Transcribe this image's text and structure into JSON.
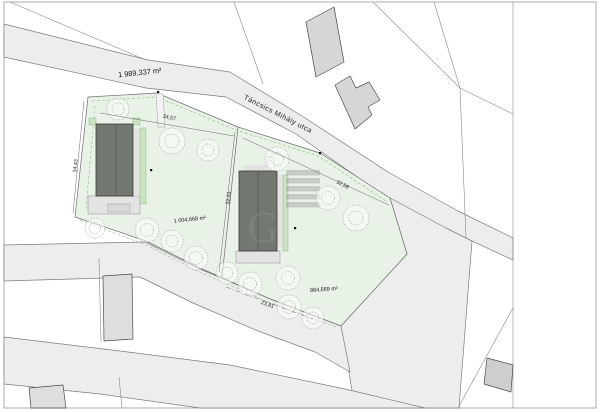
{
  "site_plan": {
    "street_name": "Táncsics Mihály utca",
    "areas": {
      "parent_parcel": "1 989,337 m²",
      "plot_left": "1 004,668 m²",
      "plot_right": "984,669 m²"
    },
    "dimensions": {
      "plot_left_front": "34,57",
      "plot_left_side": "34,43",
      "plot_right_front": "32,58",
      "plots_shared_side": "32,61",
      "plot_right_rear": "23,81"
    },
    "watermark_letter": "G"
  }
}
